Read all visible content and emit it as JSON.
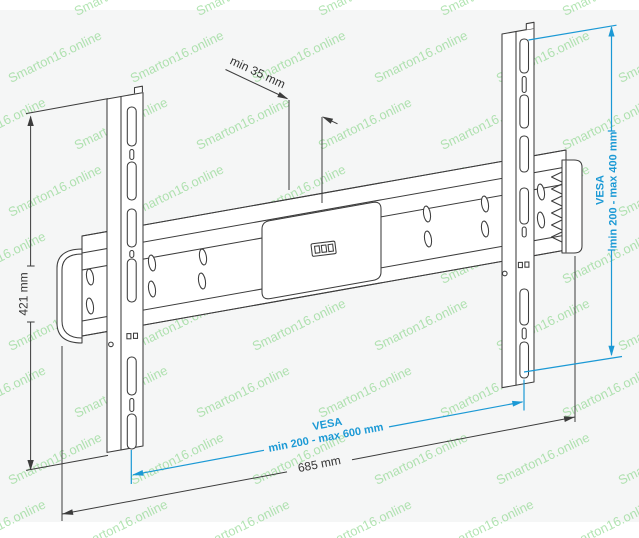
{
  "watermark": {
    "text": "Smarton16.online"
  },
  "colors": {
    "accent_blue": "#1b99d5",
    "line_dark": "#3c3c3c",
    "watermark_green": "#74cf74",
    "canvas": "#f5f6f6"
  },
  "dimensions": {
    "height_label": "421 mm",
    "depth_label": "min 35 mm",
    "width_label": "685 mm",
    "vesa_vertical_title": "VESA",
    "vesa_vertical_range": "min 200 - max 400 mm",
    "vesa_horizontal_title": "VESA",
    "vesa_horizontal_range": "min 200 - max 600 mm"
  }
}
